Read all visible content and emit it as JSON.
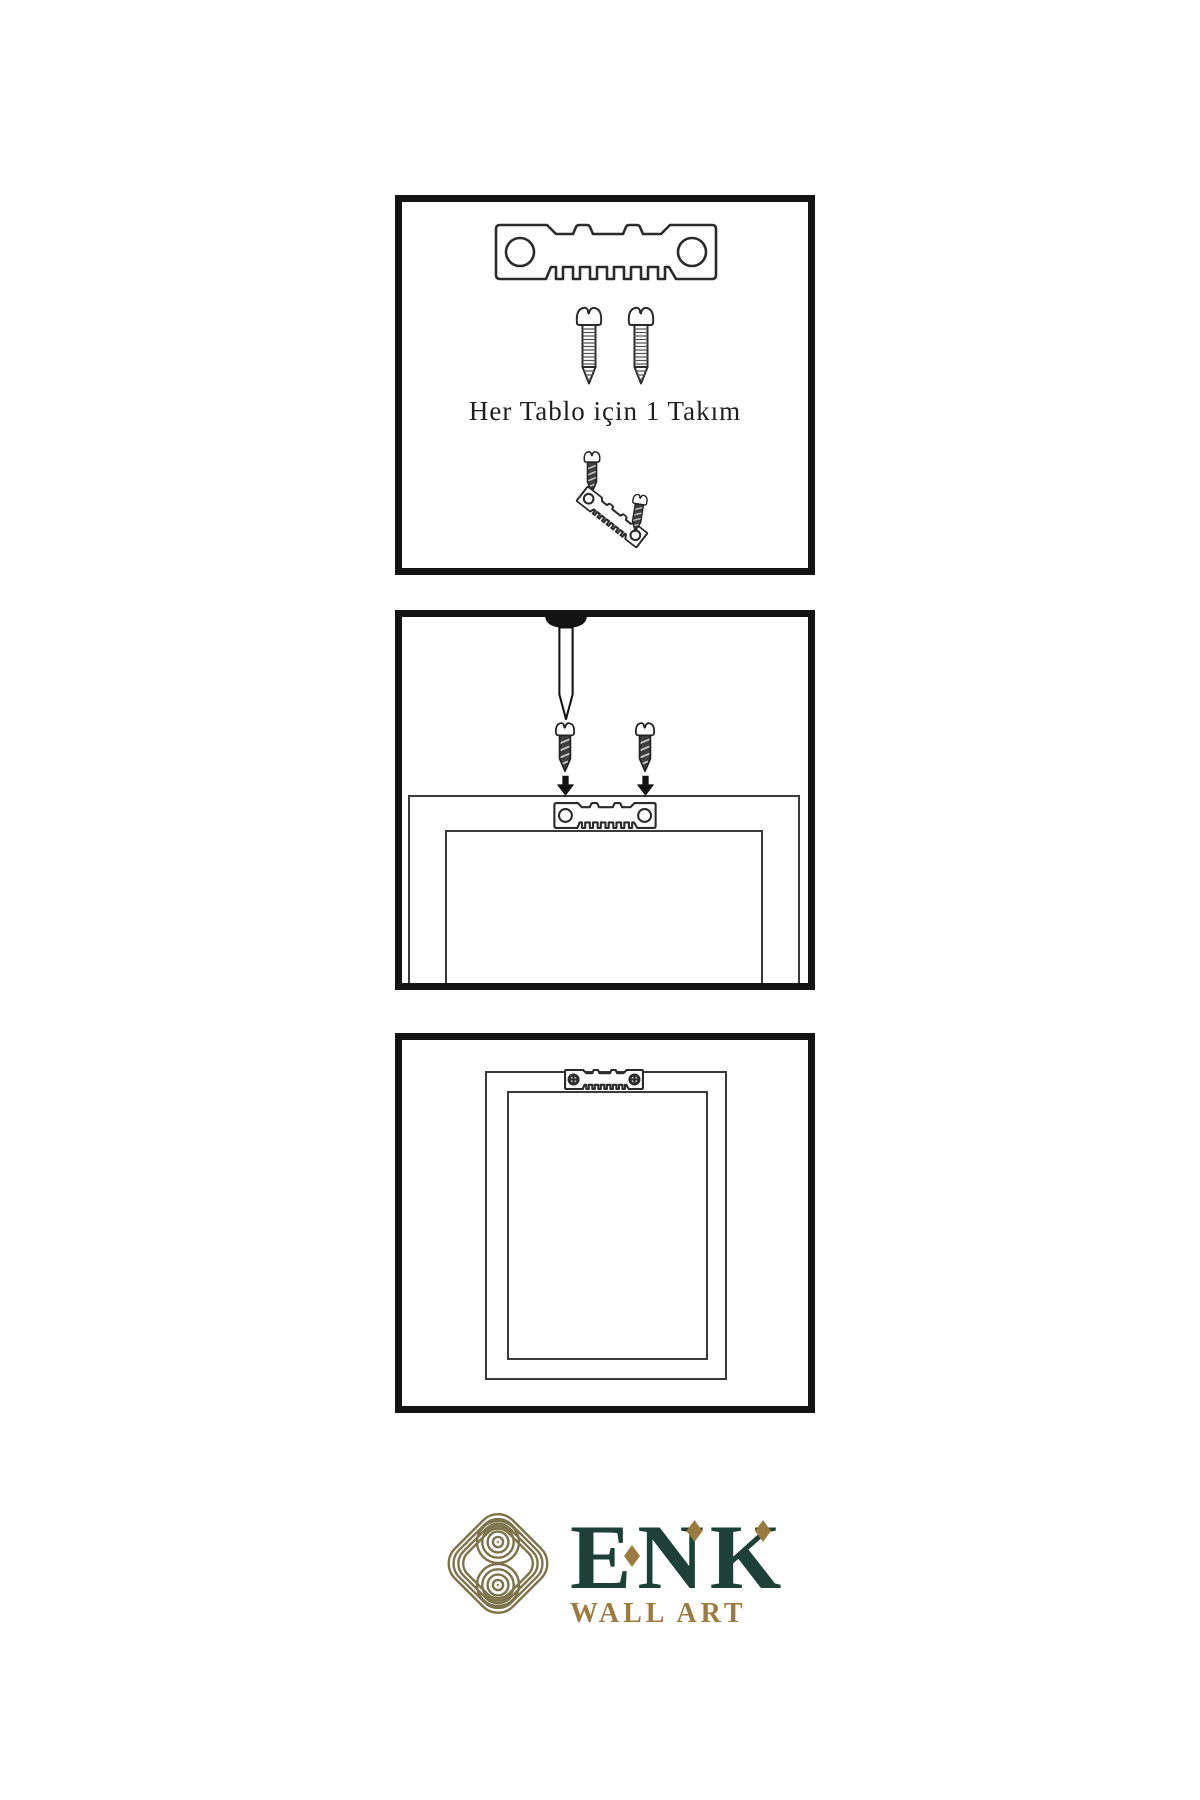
{
  "panels": {
    "kit": {
      "caption": "Her Tablo için 1 Takım"
    }
  },
  "logo": {
    "brand": "ENK",
    "tagline": "WALL ART",
    "colors": {
      "brand_green": "#1d4136",
      "accent_gold": "#9c7c3e",
      "knot_gold": "#7e744c"
    }
  },
  "icons": {
    "sawtooth_hanger": "sawtooth-hanger-icon",
    "sawtooth_hanger_screwed": "sawtooth-hanger-screwed-icon",
    "screw": "screw-icon",
    "dark_screw": "dark-screw-icon",
    "nail": "nail-icon",
    "arrow_down": "arrow-down-icon",
    "knot": "knot-logo-icon",
    "diamond": "diamond-accent-icon"
  }
}
